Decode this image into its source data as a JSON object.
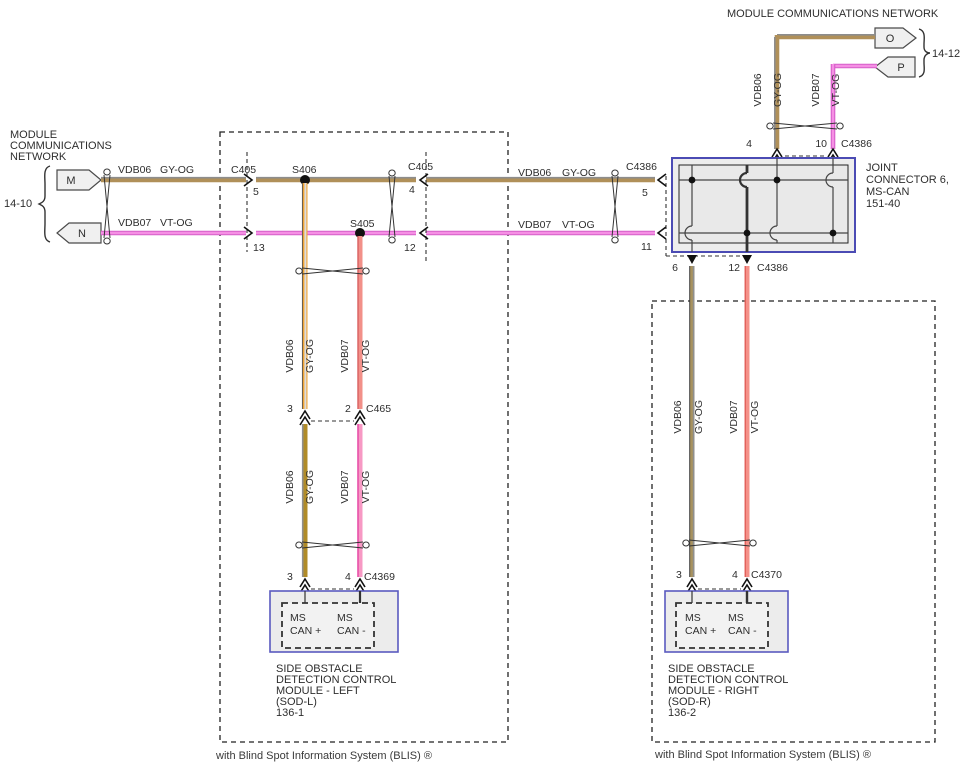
{
  "network_left": {
    "title_lines": [
      "MODULE",
      "COMMUNICATIONS",
      "NETWORK"
    ],
    "ref": "14-10",
    "connector_m": "M",
    "connector_n": "N"
  },
  "network_top_right": {
    "title": "MODULE COMMUNICATIONS NETWORK",
    "ref": "14-12",
    "connector_o": "O",
    "connector_p": "P"
  },
  "circuits": {
    "high": {
      "id": "VDB06",
      "color_code": "GY-OG"
    },
    "low": {
      "id": "VDB07",
      "color_code": "VT-OG"
    }
  },
  "splices": {
    "s406": "S406",
    "s405": "S405"
  },
  "connectors": {
    "c405_left": {
      "name": "C405",
      "pin_high": "5",
      "pin_low": "13"
    },
    "c405_right": {
      "name": "C405",
      "pin_high": "4",
      "pin_low": "12"
    },
    "c4386_left": {
      "name": "C4386",
      "pin_high": "5",
      "pin_low": "11"
    },
    "c4386_top": {
      "name": "C4386",
      "pin_high": "4",
      "pin_low": "10"
    },
    "c4386_bottom": {
      "name": "C4386",
      "pin_high": "6",
      "pin_low": "12"
    },
    "c465": {
      "name": "C465",
      "pin_high": "3",
      "pin_low": "2"
    },
    "c4369": {
      "name": "C4369",
      "pin_high": "3",
      "pin_low": "4"
    },
    "c4370": {
      "name": "C4370",
      "pin_high": "3",
      "pin_low": "4"
    }
  },
  "joint_connector": {
    "label_lines": [
      "JOINT",
      "CONNECTOR 6,",
      "MS-CAN",
      "151-40"
    ]
  },
  "modules": {
    "sod_left": {
      "pin_plus_1": "MS",
      "pin_plus_2": "CAN +",
      "pin_minus_1": "MS",
      "pin_minus_2": "CAN -",
      "label_lines": [
        "SIDE OBSTACLE",
        "DETECTION CONTROL",
        "MODULE - LEFT",
        "(SOD-L)",
        "136-1"
      ]
    },
    "sod_right": {
      "pin_plus_1": "MS",
      "pin_plus_2": "CAN +",
      "pin_minus_1": "MS",
      "pin_minus_2": "CAN -",
      "label_lines": [
        "SIDE OBSTACLE",
        "DETECTION CONTROL",
        "MODULE - RIGHT",
        "(SOD-R)",
        "136-2"
      ]
    }
  },
  "footnotes": {
    "left": "with Blind Spot Information System (BLIS) ®",
    "right": "with Blind Spot Information System (BLIS) ®"
  },
  "palette": {
    "gy_og_tan": "#b09059",
    "gy_stripe_gray": "#8d8d8d",
    "gy_og_orange": "#f0a435",
    "gy_og_gold": "#b08b28",
    "vt_og_magenta": "#d55cc8",
    "vt_og_pink": "#f590e4",
    "vt_og_salmon": "#f29089",
    "module_box_blue": "#4b4bb4"
  }
}
